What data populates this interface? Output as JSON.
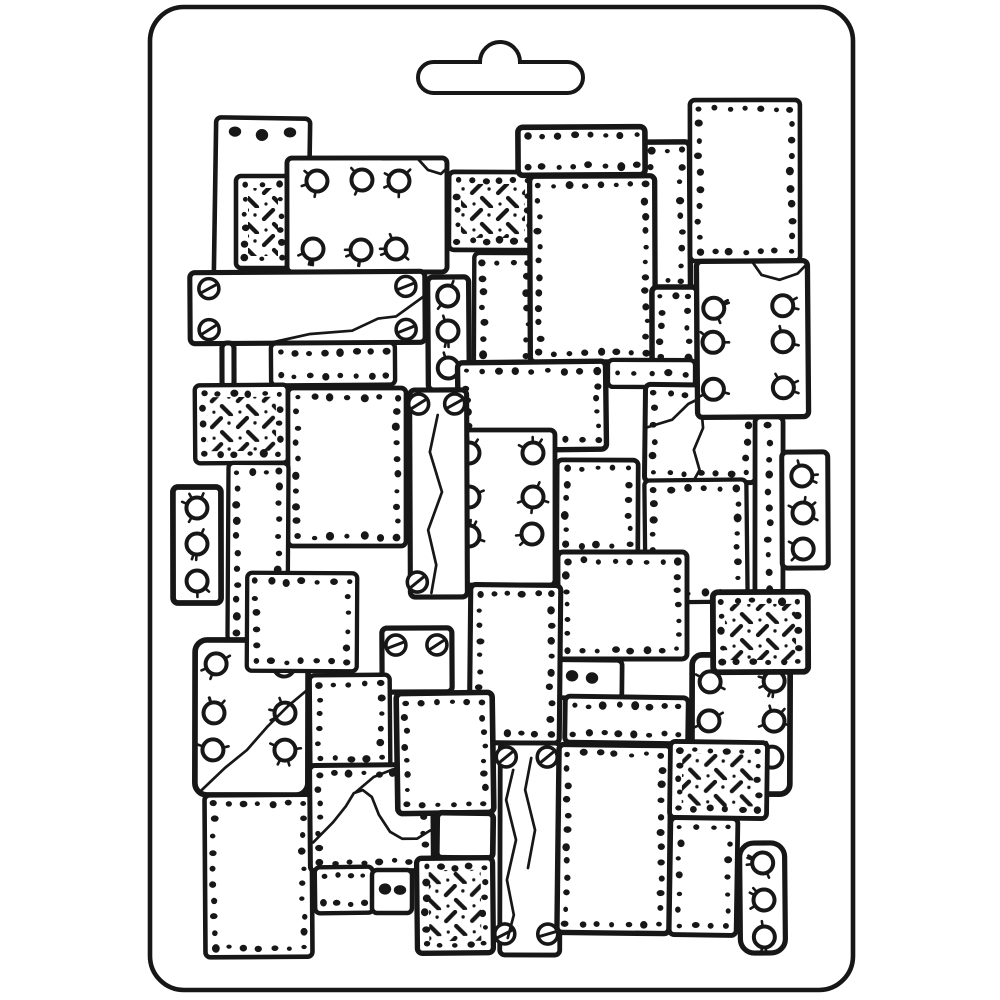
{
  "illustration": {
    "subject": "white plastic craft soft-mould sheet with euro hang tab, embossed hand-drawn pattern of overlapping riveted metal plates",
    "colors": {
      "background": "#ffffff",
      "ink": "#171717",
      "plate_fill": "#ffffff"
    },
    "mold": {
      "x": 150,
      "y": 7,
      "width": 703,
      "height": 983,
      "corner_radius": 34,
      "stroke_width": 4.6
    },
    "hanger_slot": {
      "left": 418,
      "right": 583,
      "top": 62,
      "bottom": 93,
      "end_radius": 15.5,
      "bump_left": 480,
      "bump_right": 520,
      "bump_radius": 20,
      "stroke_width": 4
    },
    "pattern_config": {
      "rivet_inset": 9,
      "rivet_spacing": 15.5,
      "rivet_radius": 3.0,
      "bolt_radius": 10.5,
      "screw_radius": 10,
      "hatch_tile": 26
    },
    "plates": [
      {
        "id": "tall-top-left",
        "x": 215,
        "y": 118,
        "w": 94,
        "h": 160,
        "style": "plain",
        "blobs": [
          [
            234,
            132
          ],
          [
            261,
            135
          ],
          [
            289,
            132
          ]
        ]
      },
      {
        "id": "diamond-a",
        "x": 236,
        "y": 176,
        "w": 54,
        "h": 92,
        "style": "diamond"
      },
      {
        "id": "bolts-a",
        "x": 287,
        "y": 158,
        "w": 160,
        "h": 114,
        "style": "plain",
        "bolts": [
          [
            317,
            181
          ],
          [
            362,
            180
          ],
          [
            399,
            181
          ],
          [
            313,
            249
          ],
          [
            361,
            250
          ],
          [
            396,
            249
          ]
        ],
        "cracks": [
          [
            [
              418,
              159
            ],
            [
              428,
              170
            ],
            [
              441,
              174
            ],
            [
              447,
              168
            ]
          ]
        ]
      },
      {
        "id": "diamond-b",
        "x": 449,
        "y": 172,
        "w": 88,
        "h": 78,
        "style": "diamond"
      },
      {
        "id": "strip-a",
        "x": 643,
        "y": 142,
        "w": 47,
        "h": 148,
        "style": "rivets"
      },
      {
        "id": "rivets-top-right",
        "x": 690,
        "y": 100,
        "w": 110,
        "h": 161,
        "style": "rivets"
      },
      {
        "id": "bar-a",
        "x": 518,
        "y": 127,
        "w": 127,
        "h": 48,
        "style": "rivets"
      },
      {
        "id": "rivets-b",
        "x": 474,
        "y": 253,
        "w": 62,
        "h": 157,
        "style": "rivets"
      },
      {
        "id": "rivets-center",
        "x": 530,
        "y": 176,
        "w": 125,
        "h": 186,
        "style": "rivets"
      },
      {
        "id": "rivets-c",
        "x": 652,
        "y": 287,
        "w": 45,
        "h": 94,
        "style": "rivets"
      },
      {
        "id": "bar-b",
        "x": 608,
        "y": 360,
        "w": 87,
        "h": 27,
        "style": "rivets"
      },
      {
        "id": "crack-a",
        "x": 645,
        "y": 385,
        "w": 111,
        "h": 97,
        "style": "rivets",
        "cracks": [
          [
            [
              647,
              428
            ],
            [
              672,
              420
            ],
            [
              688,
              404
            ],
            [
              700,
              398
            ],
            [
              712,
              398
            ]
          ],
          [
            [
              700,
              398
            ],
            [
              703,
              428
            ],
            [
              694,
              450
            ],
            [
              700,
              470
            ],
            [
              694,
              481
            ]
          ]
        ]
      },
      {
        "id": "bolts-b",
        "x": 697,
        "y": 261,
        "w": 111,
        "h": 156,
        "style": "plain",
        "bolts": [
          [
            714,
            308
          ],
          [
            783,
            306
          ],
          [
            713,
            342
          ],
          [
            783,
            342
          ],
          [
            713,
            389
          ],
          [
            783,
            388
          ]
        ],
        "cracks": [
          [
            [
              753,
              262
            ],
            [
              762,
              275
            ],
            [
              780,
              280
            ],
            [
              798,
              274
            ],
            [
              808,
              264
            ]
          ]
        ]
      },
      {
        "id": "bolts-c",
        "x": 428,
        "y": 277,
        "w": 41,
        "h": 113,
        "style": "plain",
        "bolts": [
          [
            448,
            296
          ],
          [
            448,
            331
          ],
          [
            448,
            368
          ]
        ]
      },
      {
        "id": "screw-bar",
        "x": 190,
        "y": 272,
        "w": 235,
        "h": 71,
        "style": "plain",
        "screws": [
          [
            209,
            288
          ],
          [
            209,
            329
          ],
          [
            406,
            287
          ],
          [
            406,
            330
          ]
        ],
        "cracks": [
          [
            [
              268,
              343
            ],
            [
              310,
              334
            ],
            [
              352,
              331
            ],
            [
              378,
              319
            ],
            [
              396,
              317
            ],
            [
              424,
              297
            ]
          ]
        ]
      },
      {
        "id": "connector",
        "x": 222,
        "y": 343,
        "w": 12,
        "h": 44,
        "style": "plain"
      },
      {
        "id": "bar-c",
        "x": 271,
        "y": 343,
        "w": 124,
        "h": 42,
        "style": "rivets"
      },
      {
        "id": "diamond-c",
        "x": 195,
        "y": 385,
        "w": 93,
        "h": 78,
        "style": "diamond"
      },
      {
        "id": "rivets-d",
        "x": 288,
        "y": 388,
        "w": 118,
        "h": 158,
        "style": "rivets"
      },
      {
        "id": "rivets-e",
        "x": 228,
        "y": 463,
        "w": 60,
        "h": 178,
        "style": "rivets"
      },
      {
        "id": "bolts-d",
        "x": 173,
        "y": 487,
        "w": 48,
        "h": 116,
        "style": "plain",
        "bolts": [
          [
            197,
            508
          ],
          [
            197,
            544
          ],
          [
            197,
            581
          ]
        ]
      },
      {
        "id": "rivets-f",
        "x": 458,
        "y": 362,
        "w": 148,
        "h": 88,
        "style": "rivets"
      },
      {
        "id": "bolts-e",
        "x": 447,
        "y": 430,
        "w": 108,
        "h": 155,
        "style": "plain",
        "bolts": [
          [
            469,
            453
          ],
          [
            533,
            453
          ],
          [
            469,
            497
          ],
          [
            533,
            497
          ],
          [
            469,
            536
          ],
          [
            532,
            534
          ]
        ]
      },
      {
        "id": "screws-a",
        "x": 410,
        "y": 390,
        "w": 57,
        "h": 207,
        "style": "plain",
        "screws": [
          [
            419,
            404
          ],
          [
            455,
            404
          ],
          [
            417,
            582
          ]
        ],
        "cracks": [
          [
            [
              438,
              415
            ],
            [
              430,
              452
            ],
            [
              442,
              492
            ],
            [
              428,
              530
            ],
            [
              436,
              565
            ],
            [
              431,
              593
            ]
          ]
        ]
      },
      {
        "id": "rivets-g",
        "x": 557,
        "y": 460,
        "w": 81,
        "h": 94,
        "style": "rivets"
      },
      {
        "id": "rivets-h",
        "x": 645,
        "y": 480,
        "w": 102,
        "h": 122,
        "style": "rivets"
      },
      {
        "id": "strip-b",
        "x": 755,
        "y": 417,
        "w": 28,
        "h": 180,
        "style": "rivets"
      },
      {
        "id": "bolts-f",
        "x": 782,
        "y": 452,
        "w": 46,
        "h": 116,
        "style": "plain",
        "bolts": [
          [
            802,
            476
          ],
          [
            803,
            513
          ],
          [
            803,
            549
          ]
        ]
      },
      {
        "id": "rivets-square",
        "x": 558,
        "y": 552,
        "w": 129,
        "h": 107,
        "style": "rivets"
      },
      {
        "id": "small-a",
        "x": 558,
        "y": 660,
        "w": 64,
        "h": 38,
        "style": "plain",
        "blobs": [
          [
            572,
            676
          ],
          [
            592,
            678
          ]
        ]
      },
      {
        "id": "bolts-g",
        "x": 692,
        "y": 655,
        "w": 98,
        "h": 139,
        "style": "plain",
        "r": 10,
        "bolts": [
          [
            710,
            682
          ],
          [
            774,
            681
          ],
          [
            709,
            721
          ],
          [
            774,
            721
          ],
          [
            710,
            759
          ],
          [
            772,
            757
          ]
        ]
      },
      {
        "id": "diamond-d",
        "x": 713,
        "y": 592,
        "w": 95,
        "h": 80,
        "style": "diamond"
      },
      {
        "id": "bar-d",
        "x": 565,
        "y": 697,
        "w": 123,
        "h": 46,
        "style": "rivets"
      },
      {
        "id": "bolts-crack",
        "x": 195,
        "y": 640,
        "w": 113,
        "h": 155,
        "style": "plain",
        "r": 12,
        "bolts": [
          [
            216,
            664
          ],
          [
            284,
            666
          ],
          [
            214,
            713
          ],
          [
            285,
            713
          ],
          [
            213,
            750
          ],
          [
            285,
            750
          ]
        ],
        "cracks": [
          [
            [
              201,
              791
            ],
            [
              225,
              768
            ],
            [
              247,
              750
            ],
            [
              268,
              726
            ],
            [
              288,
              706
            ],
            [
              307,
              690
            ]
          ]
        ]
      },
      {
        "id": "rivets-i",
        "x": 247,
        "y": 573,
        "w": 110,
        "h": 98,
        "style": "rivets"
      },
      {
        "id": "screws-b",
        "x": 382,
        "y": 628,
        "w": 70,
        "h": 64,
        "style": "plain",
        "screws": [
          [
            396,
            645
          ],
          [
            437,
            645
          ]
        ]
      },
      {
        "id": "rivets-j",
        "x": 470,
        "y": 585,
        "w": 90,
        "h": 158,
        "style": "rivets"
      },
      {
        "id": "rivets-k",
        "x": 205,
        "y": 795,
        "w": 107,
        "h": 162,
        "style": "rivets"
      },
      {
        "id": "rivets-l",
        "x": 310,
        "y": 675,
        "w": 80,
        "h": 92,
        "style": "rivets"
      },
      {
        "id": "crack-b",
        "x": 310,
        "y": 765,
        "w": 123,
        "h": 106,
        "style": "rivets",
        "cracks": [
          [
            [
              313,
              842
            ],
            [
              333,
              822
            ],
            [
              346,
              806
            ],
            [
              354,
              793
            ],
            [
              363,
              790
            ],
            [
              372,
              797
            ],
            [
              379,
              815
            ],
            [
              390,
              832
            ],
            [
              402,
              839
            ],
            [
              417,
              839
            ],
            [
              430,
              831
            ]
          ],
          [
            [
              356,
              792
            ],
            [
              374,
              777
            ],
            [
              392,
              770
            ],
            [
              408,
              766
            ]
          ]
        ]
      },
      {
        "id": "small-b",
        "x": 315,
        "y": 867,
        "w": 58,
        "h": 46,
        "style": "rivets"
      },
      {
        "id": "small-c",
        "x": 372,
        "y": 870,
        "w": 40,
        "h": 43,
        "style": "plain",
        "blobs": [
          [
            385,
            889
          ],
          [
            400,
            890
          ]
        ]
      },
      {
        "id": "rivets-m",
        "x": 397,
        "y": 693,
        "w": 96,
        "h": 120,
        "style": "rivets"
      },
      {
        "id": "small-d",
        "x": 437,
        "y": 813,
        "w": 56,
        "h": 45,
        "style": "plain"
      },
      {
        "id": "diamond-e",
        "x": 417,
        "y": 858,
        "w": 76,
        "h": 95,
        "style": "diamond"
      },
      {
        "id": "screws-c",
        "x": 500,
        "y": 743,
        "w": 60,
        "h": 212,
        "style": "plain",
        "screws": [
          [
            506,
            757
          ],
          [
            547,
            757
          ],
          [
            505,
            934
          ],
          [
            548,
            934
          ]
        ],
        "cracks": [
          [
            [
              513,
              770
            ],
            [
              506,
              800
            ],
            [
              516,
              840
            ],
            [
              507,
              880
            ],
            [
              514,
              915
            ],
            [
              508,
              938
            ]
          ],
          [
            [
              531,
              758
            ],
            [
              525,
              790
            ],
            [
              535,
              830
            ],
            [
              528,
              868
            ]
          ]
        ]
      },
      {
        "id": "rivets-n",
        "x": 558,
        "y": 745,
        "w": 112,
        "h": 188,
        "style": "rivets"
      },
      {
        "id": "diamond-f",
        "x": 670,
        "y": 742,
        "w": 97,
        "h": 76,
        "style": "diamond"
      },
      {
        "id": "rivets-o",
        "x": 670,
        "y": 818,
        "w": 67,
        "h": 117,
        "style": "rivets"
      },
      {
        "id": "bolts-h",
        "x": 740,
        "y": 843,
        "w": 45,
        "h": 110,
        "style": "plain",
        "r": 14,
        "bolts": [
          [
            763,
            863
          ],
          [
            764,
            900
          ],
          [
            764,
            937
          ]
        ]
      }
    ]
  }
}
